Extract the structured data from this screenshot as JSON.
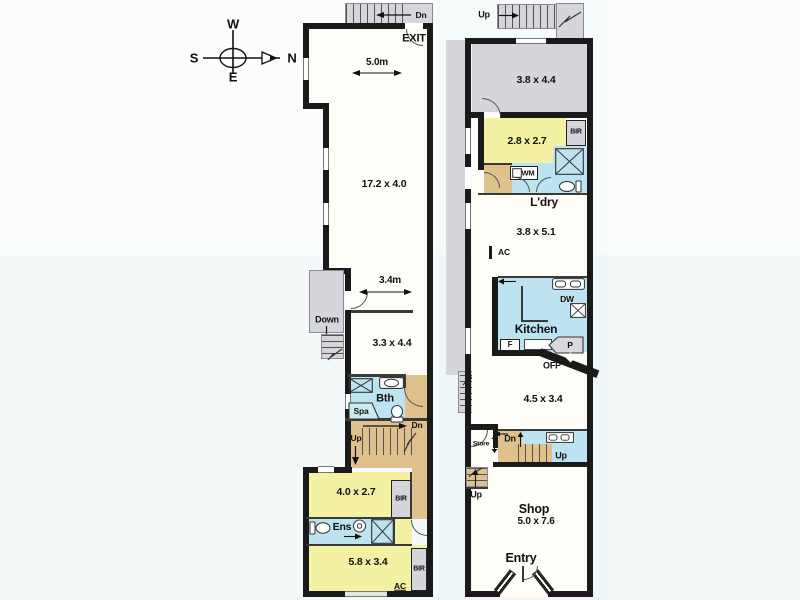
{
  "compass": {
    "w": "W",
    "s": "S",
    "n": "N",
    "e": "E"
  },
  "upper": {
    "dn_top": "Dn",
    "exit": "EXIT",
    "dim_top": "5.0m",
    "living": "17.2 x 4.0",
    "down": "Down",
    "dim_mid": "3.4m",
    "room_mid": "3.3 x 4.4",
    "bth": "Bth",
    "spa": "Spa",
    "dn_mid": "Dn",
    "up_mid": "Up",
    "bed1": "4.0 x 2.7",
    "bir1": "BIR",
    "ens": "Ens",
    "bed2": "5.8 x 3.4",
    "bir2": "BIR",
    "ac": "AC"
  },
  "ground": {
    "up_top": "Up",
    "room_top": "3.8 x 4.4",
    "room2": "2.8 x 2.7",
    "bir": "BIR",
    "wm": "WM",
    "ldry": "L'dry",
    "room3": "3.8 x 5.1",
    "ac": "AC",
    "dw": "DW",
    "kitchen": "Kitchen",
    "fridge": "F",
    "pantry": "P",
    "ofp": "OFP",
    "room4": "4.5 x 3.4",
    "up_passage": "Up",
    "store": "Store",
    "dn": "Dn",
    "up_mid": "Up",
    "up_shop": "Up",
    "shop": "Shop",
    "shop_dim": "5.0 x 7.6",
    "entry": "Entry"
  },
  "colors": {
    "wall": "#1a1a1a",
    "room_yellow": "#f5f1a3",
    "wet_blue": "#bce3ef",
    "stair_tan": "#dec18d",
    "external_gray": "#d6d5dc",
    "background": "#fbfdfc"
  }
}
